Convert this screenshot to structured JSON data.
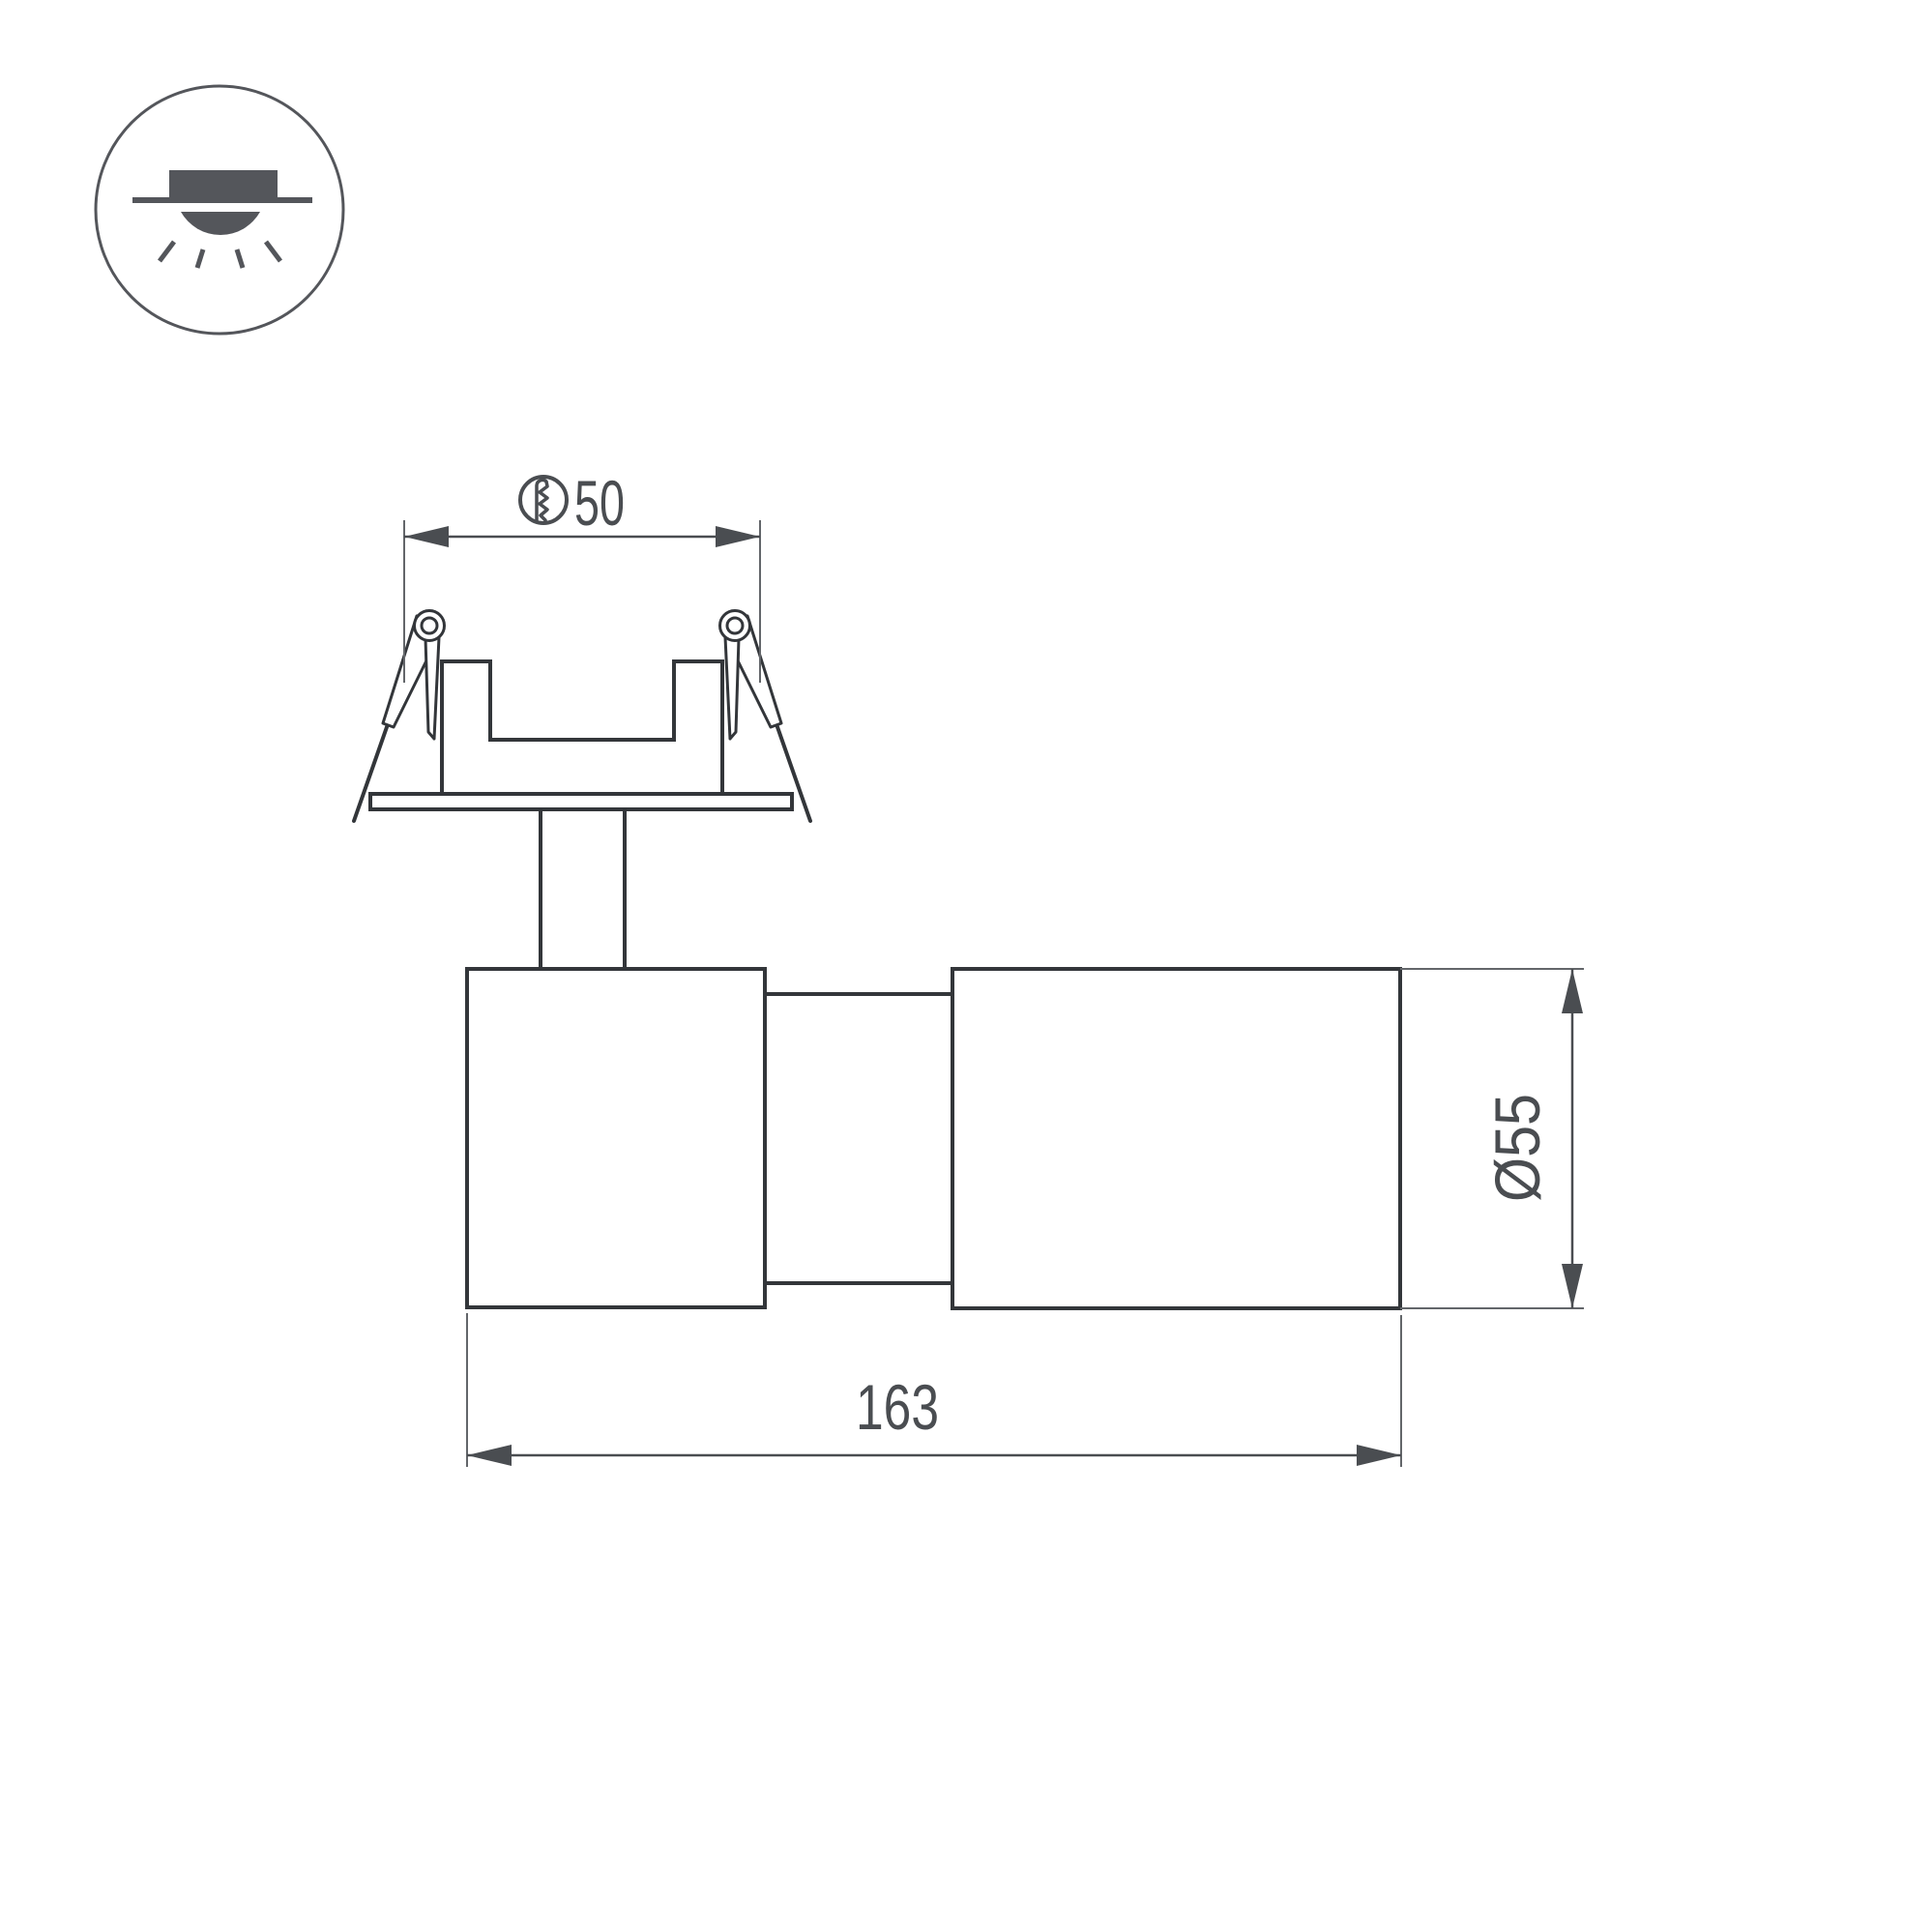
{
  "icon": {
    "name": "recessed-downlight-icon",
    "meaning": "recessed ceiling mounting"
  },
  "dimensions": {
    "cutout": {
      "label": "50",
      "symbol": "hole-saw-icon"
    },
    "diameter": {
      "label": "Ø55"
    },
    "length": {
      "label": "163"
    }
  },
  "colors": {
    "background": "#ffffff",
    "outline": "#33363a",
    "dimension": "#4a4d51",
    "thin_line": "#63666a",
    "icon_fill": "#54565b"
  }
}
